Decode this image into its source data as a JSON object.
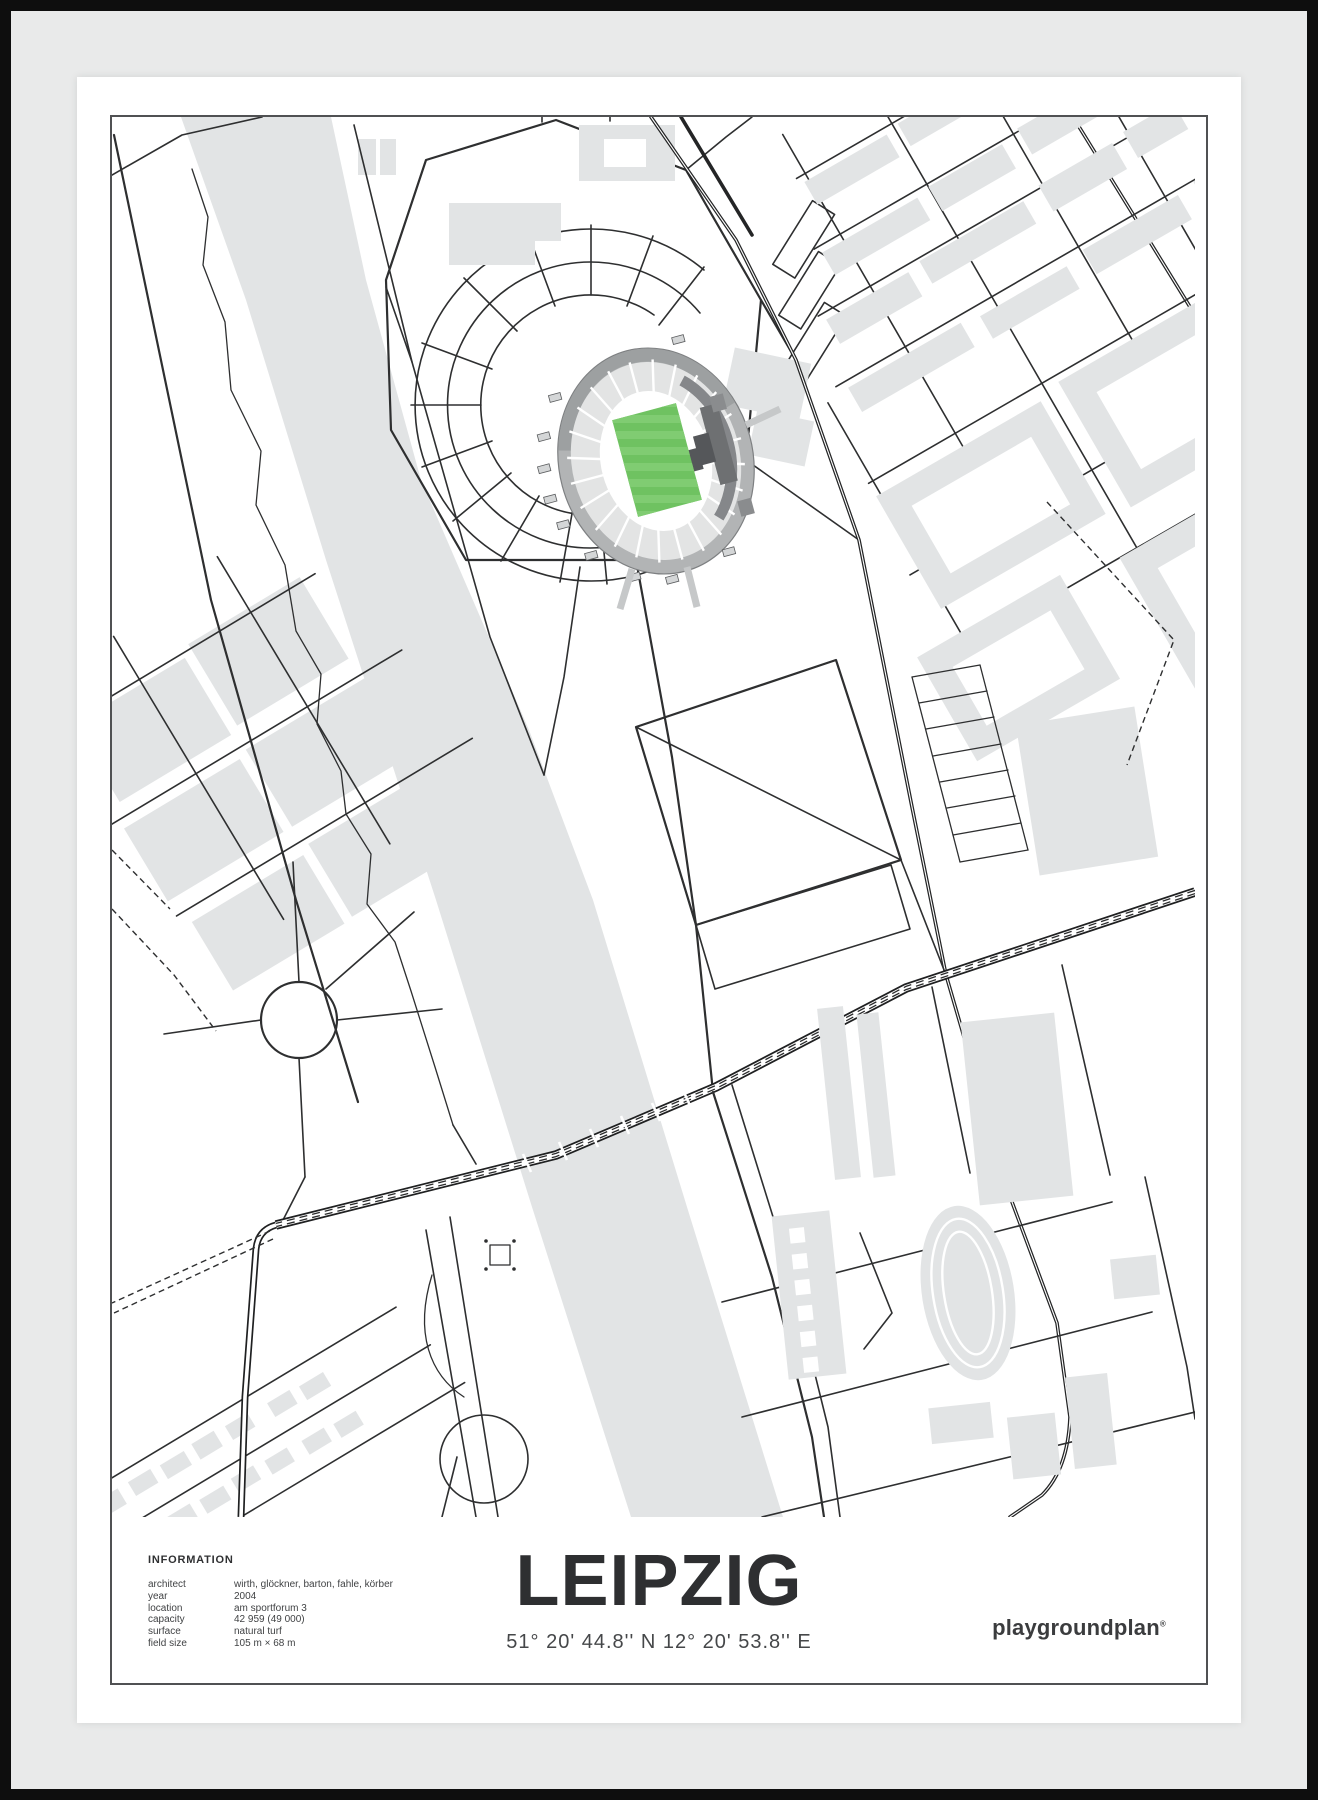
{
  "poster": {
    "title": "LEIPZIG",
    "coordinates": "51° 20' 44.8'' N  12° 20' 53.8'' E",
    "brand": "playgroundplan",
    "brand_mark": "®",
    "info": {
      "heading": "INFORMATION",
      "rows": [
        {
          "label": "architect",
          "value": "wirth, glöckner, barton, fahle, körber"
        },
        {
          "label": "year",
          "value": "2004"
        },
        {
          "label": "location",
          "value": "am sportforum 3"
        },
        {
          "label": "capacity",
          "value": "42 959 (49 000)"
        },
        {
          "label": "surface",
          "value": "natural turf"
        },
        {
          "label": "field size",
          "value": "105 m × 68 m"
        }
      ]
    },
    "map_subject": "red bull arena and sportforum district street map with river elsterflutbett"
  },
  "colors": {
    "frame": "#0e0e0e",
    "mat": "#e9eaea",
    "poster": "#ffffff",
    "border": "#505153",
    "street": "#2e2f30",
    "gray": "#e2e4e5",
    "ring": "#b2b4b5",
    "ringdark": "#9da0a1",
    "stands": "#e3e4e4",
    "standband": "#85878a",
    "pitch": "#6fc261",
    "stripe": "#80cc72"
  }
}
